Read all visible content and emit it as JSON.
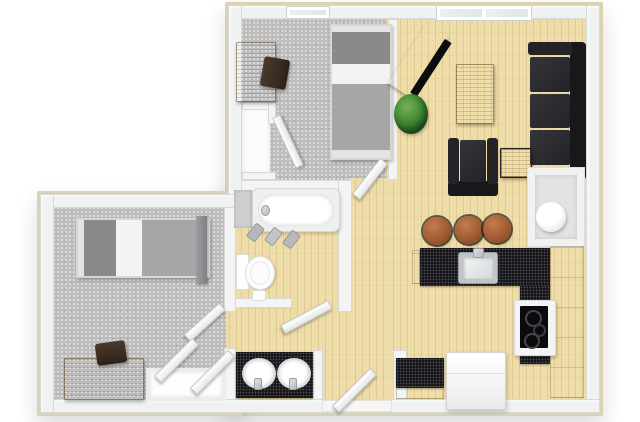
{
  "scene": {
    "kind": "3d-apartment-floor-plan-top-view",
    "background": "#ffffff",
    "rooms": [
      "bedroom-top",
      "living-room",
      "kitchen",
      "bathroom",
      "vanity-area",
      "hallway",
      "bedroom-left",
      "utility-closet",
      "closets"
    ]
  },
  "colors": {
    "outline": "#dbd2b2",
    "wall_face": "#f0f1f1",
    "wall_edge": "#d7d9d9",
    "wall_inner": "#f4f4f4",
    "carpet": "#bdbdbd",
    "wood": "#efdda9",
    "counter": "#17171b",
    "cabinet": "#e7dab6",
    "wood_furniture": "#b4651f",
    "dark_wood": "#46290f",
    "black_fabric": "#202023",
    "plant_green": "#37802e",
    "bed_dark": "#8a8a8a",
    "bed_mid": "#a6a6a6",
    "bed_light": "#f3f3f1",
    "steel": "#c3c6c8",
    "fixture_white": "#fdfdfd"
  },
  "labels": {
    "floor_plan": "3D apartment floor plan",
    "bedroom_top": "Bedroom",
    "bedroom_left": "Bedroom",
    "living_room": "Living room",
    "kitchen": "Kitchen",
    "bathroom": "Bathroom",
    "vanity": "Vanity with double sinks",
    "utility": "Utility closet",
    "water_heater": "Water heater",
    "bed": "Single bed",
    "desk": "Desk",
    "desk_chair": "Desk chair",
    "closet": "Closet",
    "window": "Window",
    "door": "Door",
    "tv_stand": "TV stand",
    "tv": "Television",
    "plant": "Plant",
    "coffee_table": "Coffee table",
    "sofa": "Sofa",
    "armchair": "Armchair",
    "side_table": "Side table",
    "bar_stool": "Bar stool",
    "kitchen_sink": "Kitchen sink",
    "kitchen_counter": "Kitchen counter",
    "cooktop": "Cooktop stove",
    "fridge": "Refrigerator",
    "cabinets": "Kitchen cabinets",
    "bathtub": "Bathtub",
    "toilet": "Toilet",
    "toilet_paper": "Toilet paper holder",
    "bath_items": "Bath accessories",
    "vanity_sink": "Vanity sink",
    "faucet": "Faucet",
    "wardrobe": "Wardrobe",
    "tile": "Tiled area",
    "entry_sill": "Entry threshold"
  }
}
